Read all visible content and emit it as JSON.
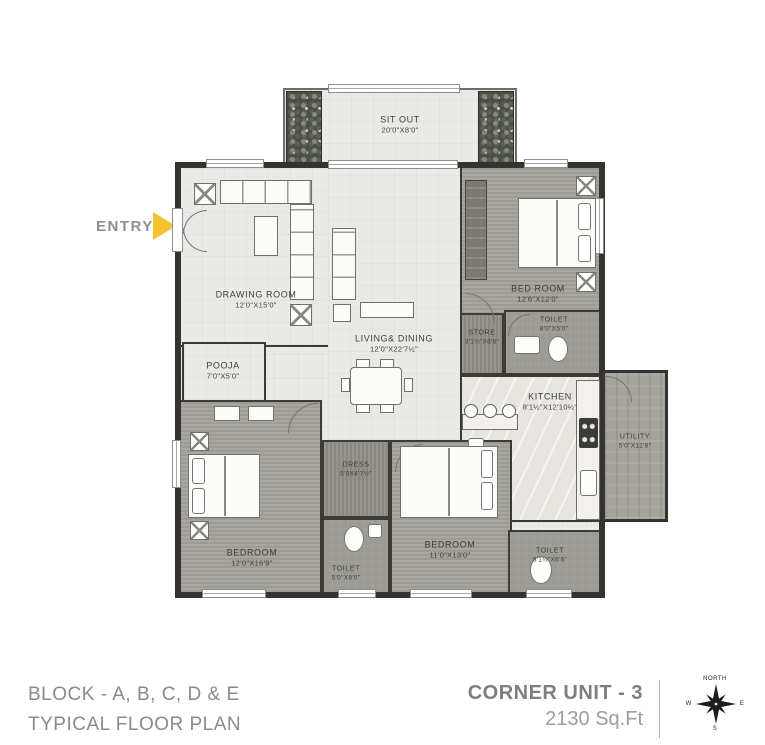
{
  "entry": {
    "label": "ENTRY"
  },
  "rooms": {
    "sit_out": {
      "name": "SIT OUT",
      "dim": "20'0\"X8'0\""
    },
    "drawing": {
      "name": "DRAWING ROOM",
      "dim": "12'0\"X15'0\""
    },
    "bed1": {
      "name": "BED ROOM",
      "dim": "12'6\"X12'0\""
    },
    "living": {
      "name": "LIVING& DINING",
      "dim": "12'0\"X22'7½\""
    },
    "pooja": {
      "name": "POOJA",
      "dim": "7'0\"X5'0\""
    },
    "store": {
      "name": "STORE",
      "dim": "3'1½\"X6'6\""
    },
    "toilet1": {
      "name": "TOILET",
      "dim": "8'0\"X5'0\""
    },
    "kitchen": {
      "name": "KITCHEN",
      "dim": "8'1½\"X12'10½\""
    },
    "utility": {
      "name": "UTILITY",
      "dim": "5'0\"X12'6\""
    },
    "bedroom2": {
      "name": "BEDROOM",
      "dim": "12'0\"X16'9\""
    },
    "dress": {
      "name": "DRESS",
      "dim": "5'0X4'7½\""
    },
    "toilet2": {
      "name": "TOILET",
      "dim": "5'0\"X8'0\""
    },
    "bedroom3": {
      "name": "BEDROOM",
      "dim": "11'0\"X13'0\""
    },
    "toilet3": {
      "name": "TOILET",
      "dim": "8'1½\"X6'6\""
    }
  },
  "footer": {
    "block_line": "BLOCK -  A, B, C, D & E",
    "plan_line": "TYPICAL FLOOR PLAN",
    "unit_title": "CORNER UNIT - 3",
    "unit_area": "2130 Sq.Ft"
  },
  "compass": {
    "north": "NORTH",
    "west": "W",
    "east": "E",
    "south": "S"
  },
  "colors": {
    "accent": "#f5c331",
    "wall": "#34332f",
    "text_gray": "#8a8a8a"
  }
}
